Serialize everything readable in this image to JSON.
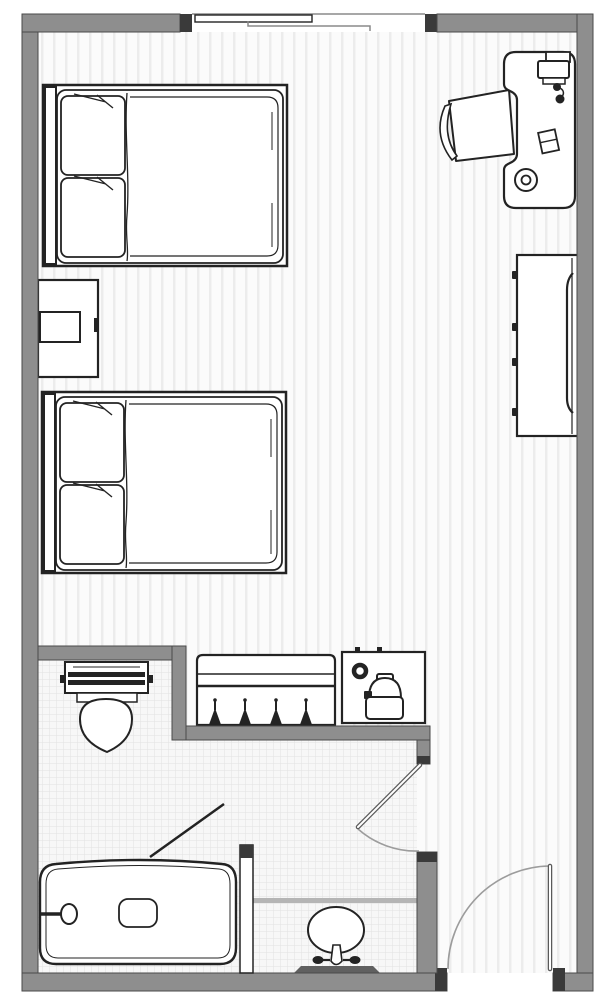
{
  "document": {
    "kind": "floor-plan",
    "view": "top-down architectural drawing",
    "subject": "hotel guest room with en-suite bathroom"
  },
  "colors": {
    "wall": "#8e8e8e",
    "wallEdge": "#4a4a4a",
    "wallCap": "#3a3a3a",
    "ink": "#232323",
    "doorArc": "#9c9c9c",
    "floorBg": "#fbfbfb",
    "floorLine": "#ececec",
    "tileBg": "#f7f7f7",
    "tileLine": "#e2e2e2"
  },
  "rooms": [
    {
      "name": "bedroom",
      "floor": "wood plank stripes",
      "items": [
        "bed-1",
        "bed-2",
        "nightstand",
        "desk",
        "desk-chair",
        "desk-lamp",
        "desk-phone",
        "desk-notepad",
        "desk-cup",
        "dresser",
        "closet with 4 hangers",
        "coffee-station"
      ]
    },
    {
      "name": "bathroom",
      "floor": "tile grid",
      "items": [
        "toilet",
        "bathtub with faucet and drain",
        "shower-curtain line",
        "vanity with oval sink and faucet"
      ]
    }
  ],
  "openings": [
    {
      "name": "sliding-window",
      "wall": "top",
      "panels": 2
    },
    {
      "name": "bathroom-door",
      "swing": "into bathroom, quarter arc"
    },
    {
      "name": "entry-door",
      "wall": "bottom",
      "swing": "inward, quarter arc"
    }
  ]
}
